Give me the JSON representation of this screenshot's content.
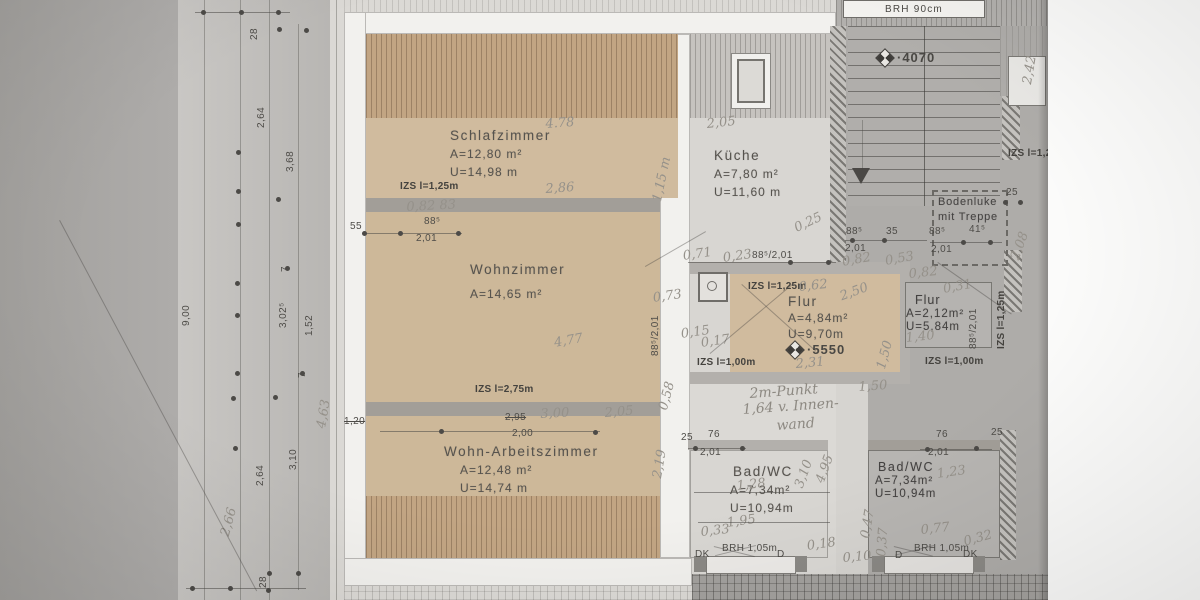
{
  "colors": {
    "paper": "#b6b4b1",
    "apartment_highlight": "#dbd9d5",
    "room_tan": "#d0bb9e",
    "hatch_tan": "#c2a583",
    "line": "#4e4c48",
    "handwriting": "#95918a"
  },
  "rooms": [
    {
      "name": "Schlafzimmer",
      "area": "A=12,80 m²",
      "perimeter": "U=14,98 m"
    },
    {
      "name": "Küche",
      "area": "A=7,80 m²",
      "perimeter": "U=11,60 m"
    },
    {
      "name": "Wohnzimmer",
      "area": "A=14,65 m²",
      "perimeter": ""
    },
    {
      "name": "Flur",
      "area": "A=4,84m²",
      "perimeter": "U=9,70m"
    },
    {
      "name": "Flur",
      "area": "A=2,12m²",
      "perimeter": "U=5,84m"
    },
    {
      "name": "Wohn-Arbeitszimmer",
      "area": "A=12,48 m²",
      "perimeter": "U=14,74 m"
    },
    {
      "name": "Bad/WC",
      "area": "A=7,34m²",
      "perimeter": "U=10,94m"
    },
    {
      "name": "Bad/WC",
      "area": "A=7,34m²",
      "perimeter": "U=10,94m"
    }
  ],
  "labels": {
    "bodenluke_line1": "Bodenluke",
    "bodenluke_line2": "mit Treppe",
    "brh_top": "BRH 90cm",
    "level_top": "·4070",
    "level_flur": "·5550"
  },
  "annotations": [
    {
      "t": "28",
      "x": 249,
      "y": 40,
      "r": -90,
      "c": "d"
    },
    {
      "t": "2,64",
      "x": 256,
      "y": 128,
      "r": -90,
      "c": "d"
    },
    {
      "t": "3,68",
      "x": 285,
      "y": 172,
      "r": -90,
      "c": "d"
    },
    {
      "t": "7",
      "x": 280,
      "y": 272,
      "r": -90,
      "c": "d"
    },
    {
      "t": "9,00",
      "x": 181,
      "y": 326,
      "r": -90,
      "c": "d"
    },
    {
      "t": "3,02⁵",
      "x": 278,
      "y": 328,
      "r": -90,
      "c": "d"
    },
    {
      "t": "1,52",
      "x": 304,
      "y": 336,
      "r": -90,
      "c": "d"
    },
    {
      "t": "7",
      "x": 297,
      "y": 378,
      "r": -90,
      "c": "d"
    },
    {
      "t": "3,10",
      "x": 288,
      "y": 470,
      "r": -90,
      "c": "d"
    },
    {
      "t": "2,64",
      "x": 255,
      "y": 486,
      "r": -90,
      "c": "d"
    },
    {
      "t": "28",
      "x": 258,
      "y": 588,
      "r": -90,
      "c": "d"
    },
    {
      "t": "2,66",
      "x": 218,
      "y": 534,
      "r": -75,
      "c": "h"
    },
    {
      "t": "4,63",
      "x": 314,
      "y": 427,
      "r": -80,
      "c": "h"
    },
    {
      "t": "IZS l=1,25m",
      "x": 400,
      "y": 181,
      "c": "z"
    },
    {
      "t": "55",
      "x": 350,
      "y": 221,
      "c": "d"
    },
    {
      "t": "88⁵",
      "x": 424,
      "y": 216,
      "c": "d"
    },
    {
      "t": "2,01",
      "x": 416,
      "y": 233,
      "c": "d"
    },
    {
      "t": "0,82 83",
      "x": 406,
      "y": 200,
      "r": -3,
      "c": "h"
    },
    {
      "t": "4.78",
      "x": 545,
      "y": 117,
      "r": -4,
      "c": "h"
    },
    {
      "t": "2,86",
      "x": 545,
      "y": 182,
      "r": -4,
      "c": "h"
    },
    {
      "t": "1,15 m",
      "x": 650,
      "y": 200,
      "r": -78,
      "c": "h"
    },
    {
      "t": "2,05",
      "x": 706,
      "y": 117,
      "r": -6,
      "c": "h"
    },
    {
      "t": "IZS l=2,75m",
      "x": 475,
      "y": 384,
      "c": "z"
    },
    {
      "t": "2,95",
      "x": 505,
      "y": 412,
      "c": "ds"
    },
    {
      "t": "3,00",
      "x": 540,
      "y": 407,
      "r": -3,
      "c": "h"
    },
    {
      "t": "2,00",
      "x": 512,
      "y": 428,
      "c": "d"
    },
    {
      "t": "1,20",
      "x": 344,
      "y": 416,
      "c": "ds"
    },
    {
      "t": "2,05",
      "x": 604,
      "y": 406,
      "r": -5,
      "c": "h"
    },
    {
      "t": "2,19",
      "x": 650,
      "y": 477,
      "r": -80,
      "c": "h"
    },
    {
      "t": "0,58",
      "x": 656,
      "y": 408,
      "r": -75,
      "c": "h"
    },
    {
      "t": "4,77",
      "x": 553,
      "y": 336,
      "r": -10,
      "c": "h"
    },
    {
      "t": "88⁵/2,01",
      "x": 650,
      "y": 356,
      "r": -90,
      "c": "d"
    },
    {
      "t": "0,71",
      "x": 682,
      "y": 249,
      "r": -8,
      "c": "h"
    },
    {
      "t": "0,23",
      "x": 722,
      "y": 251,
      "r": -8,
      "c": "h"
    },
    {
      "t": "88⁵/2,01",
      "x": 752,
      "y": 250,
      "c": "d"
    },
    {
      "t": "0,25",
      "x": 792,
      "y": 222,
      "r": -25,
      "c": "h"
    },
    {
      "t": "IZS l=1,25m",
      "x": 748,
      "y": 281,
      "c": "z"
    },
    {
      "t": "0,62",
      "x": 798,
      "y": 280,
      "r": -6,
      "c": "h"
    },
    {
      "t": "0,73",
      "x": 652,
      "y": 291,
      "r": -8,
      "c": "h"
    },
    {
      "t": "0,15",
      "x": 680,
      "y": 327,
      "r": -8,
      "c": "h"
    },
    {
      "t": "0,17",
      "x": 700,
      "y": 336,
      "r": -8,
      "c": "h"
    },
    {
      "t": "IZS l=1,00m",
      "x": 697,
      "y": 357,
      "c": "z"
    },
    {
      "t": "2,31",
      "x": 795,
      "y": 357,
      "r": -5,
      "c": "h"
    },
    {
      "t": "1,50",
      "x": 874,
      "y": 367,
      "r": -75,
      "c": "h"
    },
    {
      "t": "2,50",
      "x": 838,
      "y": 290,
      "r": -20,
      "c": "h"
    },
    {
      "t": "88⁵",
      "x": 846,
      "y": 226,
      "c": "d"
    },
    {
      "t": "35",
      "x": 886,
      "y": 226,
      "c": "d"
    },
    {
      "t": "2,01",
      "x": 845,
      "y": 243,
      "c": "d"
    },
    {
      "t": "0,82",
      "x": 841,
      "y": 255,
      "r": -10,
      "c": "h"
    },
    {
      "t": "0,53",
      "x": 884,
      "y": 254,
      "r": -10,
      "c": "h"
    },
    {
      "t": "88⁵",
      "x": 929,
      "y": 226,
      "c": "d"
    },
    {
      "t": "41⁵",
      "x": 969,
      "y": 224,
      "c": "d"
    },
    {
      "t": "2,01",
      "x": 931,
      "y": 244,
      "c": "d"
    },
    {
      "t": "25",
      "x": 1006,
      "y": 187,
      "c": "d"
    },
    {
      "t": "2,08",
      "x": 1008,
      "y": 257,
      "r": -70,
      "c": "h"
    },
    {
      "t": "0,82",
      "x": 908,
      "y": 267,
      "r": -6,
      "c": "h"
    },
    {
      "t": "0,31",
      "x": 942,
      "y": 282,
      "r": -10,
      "c": "h"
    },
    {
      "t": "88⁵/2,01",
      "x": 968,
      "y": 349,
      "r": -90,
      "c": "d"
    },
    {
      "t": "IZS l=1,25m",
      "x": 996,
      "y": 349,
      "r": -90,
      "c": "z"
    },
    {
      "t": "1,40",
      "x": 905,
      "y": 331,
      "r": -6,
      "c": "h"
    },
    {
      "t": "IZS l=1,00m",
      "x": 925,
      "y": 356,
      "c": "z"
    },
    {
      "t": "2,42",
      "x": 1020,
      "y": 83,
      "r": -80,
      "c": "h"
    },
    {
      "t": "IZS l=1,25m",
      "x": 1008,
      "y": 148,
      "c": "z"
    },
    {
      "t": "2m-Punkt",
      "x": 749,
      "y": 386,
      "r": -4,
      "c": "h2"
    },
    {
      "t": "1,64 v. Innen-",
      "x": 742,
      "y": 402,
      "r": -4,
      "c": "h2"
    },
    {
      "t": "wand",
      "x": 776,
      "y": 418,
      "r": -4,
      "c": "h2"
    },
    {
      "t": "1,50",
      "x": 858,
      "y": 380,
      "r": -4,
      "c": "h"
    },
    {
      "t": "25",
      "x": 681,
      "y": 432,
      "c": "d"
    },
    {
      "t": "76",
      "x": 708,
      "y": 429,
      "c": "d"
    },
    {
      "t": "2,01",
      "x": 700,
      "y": 447,
      "c": "d"
    },
    {
      "t": "3,10",
      "x": 792,
      "y": 485,
      "r": -70,
      "c": "h"
    },
    {
      "t": "4,95",
      "x": 813,
      "y": 480,
      "r": -70,
      "c": "h"
    },
    {
      "t": "1,28",
      "x": 736,
      "y": 479,
      "r": -6,
      "c": "h"
    },
    {
      "t": "1,95",
      "x": 726,
      "y": 516,
      "r": -8,
      "c": "h"
    },
    {
      "t": "0,33",
      "x": 700,
      "y": 525,
      "r": -6,
      "c": "h"
    },
    {
      "t": "0,18",
      "x": 806,
      "y": 539,
      "r": -8,
      "c": "h"
    },
    {
      "t": "DK",
      "x": 695,
      "y": 549,
      "c": "d"
    },
    {
      "t": "BRH 1,05m",
      "x": 722,
      "y": 543,
      "c": "d"
    },
    {
      "t": "D",
      "x": 777,
      "y": 549,
      "c": "d"
    },
    {
      "t": "0,47",
      "x": 858,
      "y": 537,
      "r": -80,
      "c": "h"
    },
    {
      "t": "0,37",
      "x": 874,
      "y": 556,
      "r": -85,
      "c": "h"
    },
    {
      "t": "0,10",
      "x": 842,
      "y": 551,
      "r": -5,
      "c": "h"
    },
    {
      "t": "76",
      "x": 936,
      "y": 429,
      "c": "d"
    },
    {
      "t": "2,01",
      "x": 928,
      "y": 447,
      "c": "d"
    },
    {
      "t": "25",
      "x": 991,
      "y": 427,
      "c": "d"
    },
    {
      "t": "1,23",
      "x": 936,
      "y": 467,
      "r": -8,
      "c": "h"
    },
    {
      "t": "0,77",
      "x": 920,
      "y": 523,
      "r": -6,
      "c": "h"
    },
    {
      "t": "0,32",
      "x": 962,
      "y": 535,
      "r": -15,
      "c": "h"
    },
    {
      "t": "D",
      "x": 895,
      "y": 550,
      "c": "d"
    },
    {
      "t": "BRH 1,05m",
      "x": 914,
      "y": 543,
      "c": "d"
    },
    {
      "t": "DK",
      "x": 963,
      "y": 549,
      "c": "d"
    }
  ]
}
